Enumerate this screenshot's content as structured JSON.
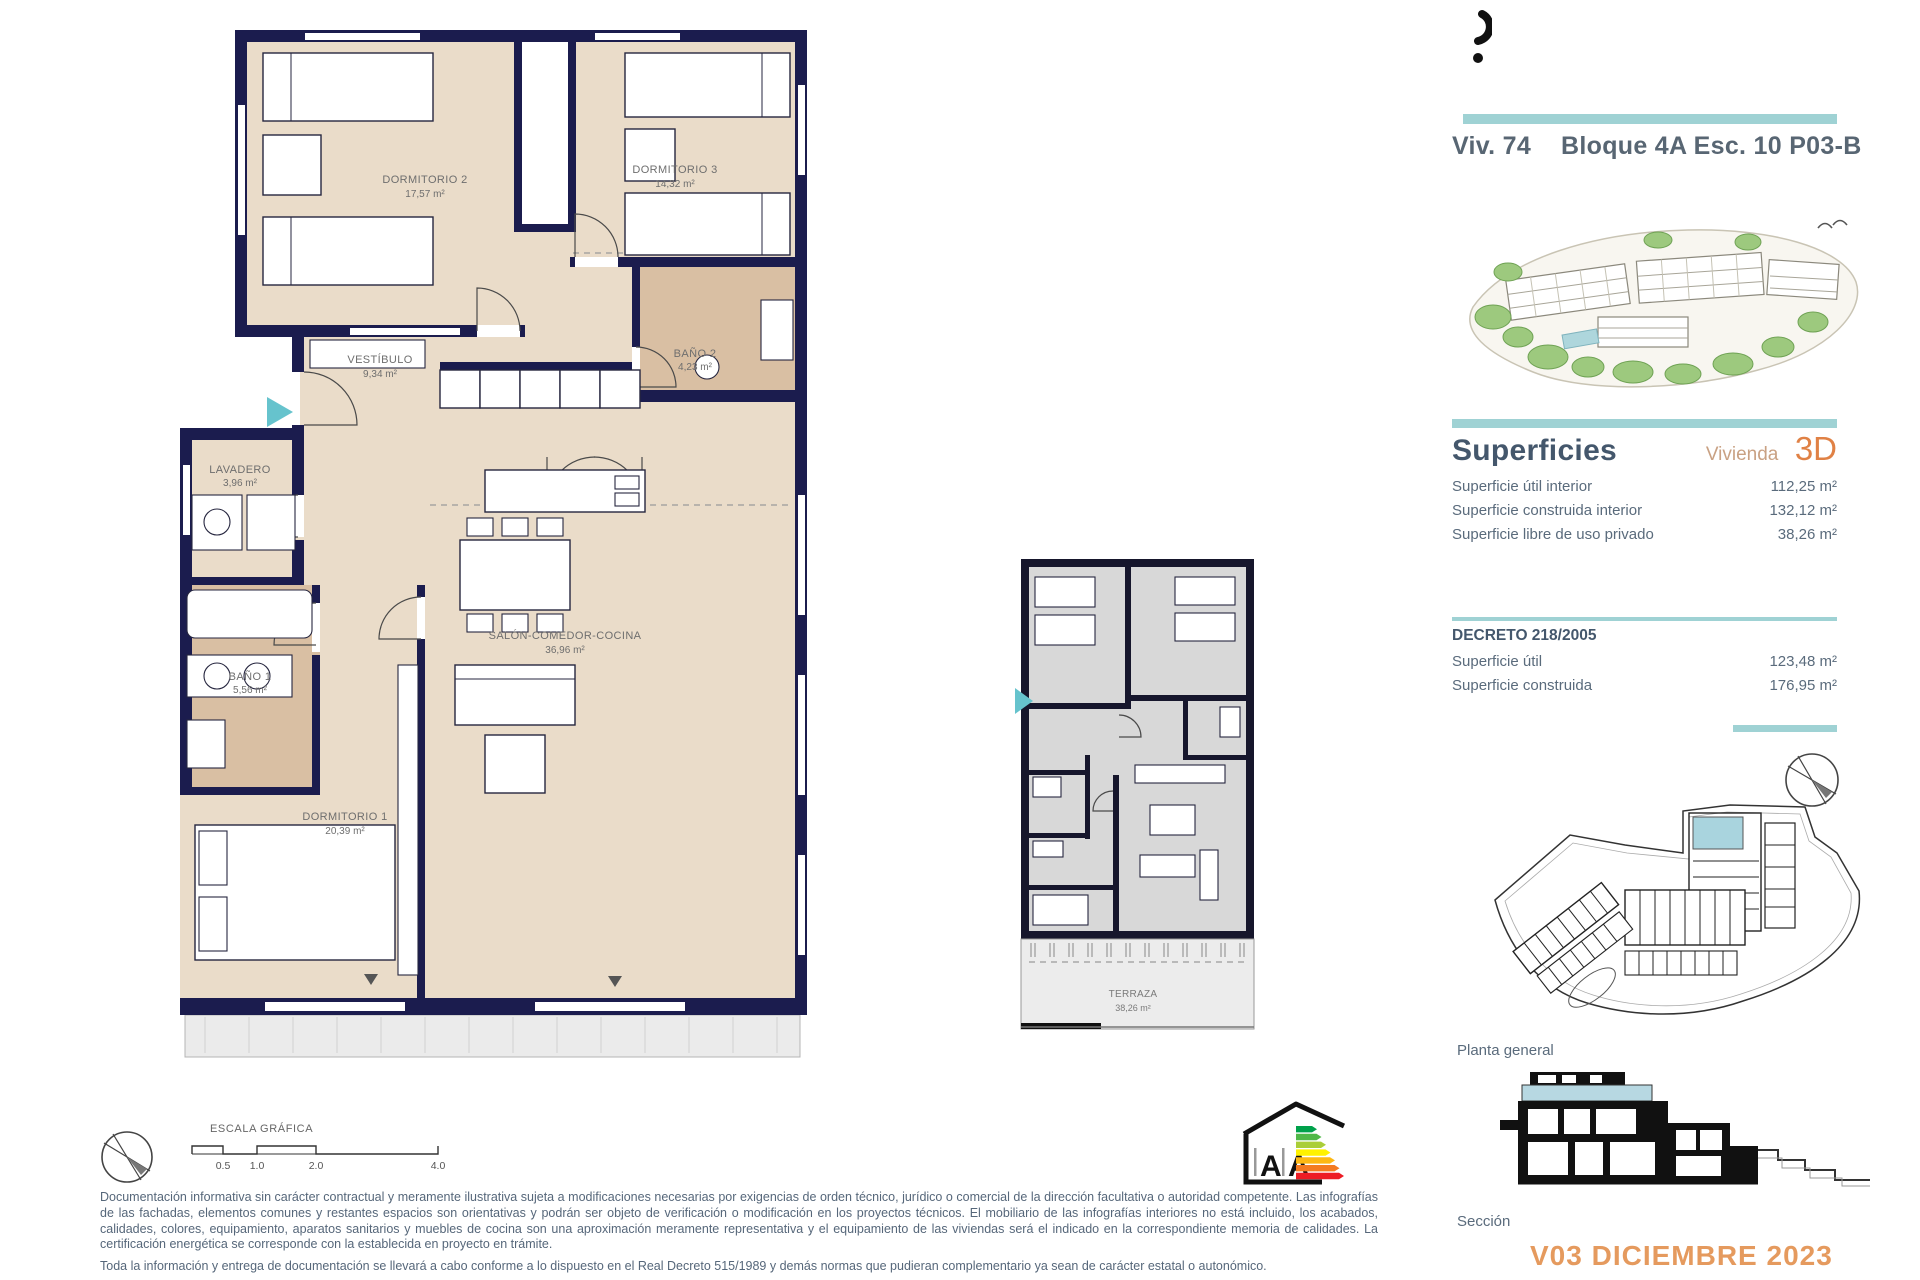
{
  "header": {
    "unit": "Viv. 74",
    "location": "Bloque 4A Esc. 10 P03-B"
  },
  "superficies": {
    "heading": "Superficies",
    "unit_label": "Vivienda",
    "unit_type": "3D",
    "rows": [
      {
        "label": "Superficie útil interior",
        "value": "112,25 m²"
      },
      {
        "label": "Superficie construida interior",
        "value": "132,12 m²"
      },
      {
        "label": "Superficie libre de uso privado",
        "value": "38,26 m²"
      }
    ]
  },
  "decreto": {
    "heading": "DECRETO 218/2005",
    "rows": [
      {
        "label": "Superficie útil",
        "value": "123,48 m²"
      },
      {
        "label": "Superficie construida",
        "value": "176,95 m²"
      }
    ]
  },
  "captions": {
    "site_plan": "Planta general",
    "section": "Sección",
    "version": "V03 DICIEMBRE 2023"
  },
  "floorplan": {
    "rooms": [
      {
        "name": "DORMITORIO 2",
        "area": "17,57 m²"
      },
      {
        "name": "DORMITORIO 3",
        "area": "14,32 m²"
      },
      {
        "name": "BAÑO 2",
        "area": "4,23 m²"
      },
      {
        "name": "VESTÍBULO",
        "area": "9,34 m²"
      },
      {
        "name": "LAVADERO",
        "area": "3,96 m²"
      },
      {
        "name": "BAÑO 1",
        "area": "5,56 m²"
      },
      {
        "name": "SALÓN-COMEDOR-COCINA",
        "area": "36,96 m²"
      },
      {
        "name": "DORMITORIO 1",
        "area": "20,39 m²"
      }
    ],
    "terrace": {
      "name": "TERRAZA",
      "area": "38,26 m²"
    }
  },
  "scale_bar": {
    "title": "ESCALA GRÁFICA",
    "ticks": [
      "0.5",
      "1.0",
      "2.0",
      "4.0"
    ]
  },
  "energy": {
    "left": "A",
    "right": "A"
  },
  "disclaimer": {
    "p1": "Documentación informativa sin carácter contractual y meramente ilustrativa sujeta a modificaciones necesarias por exigencias de orden técnico, jurídico o comercial de la dirección facultativa o autoridad competente. Las infografías de las fachadas, elementos comunes y restantes espacios son orientativas y podrán ser objeto de verificación o modificación en los proyectos técnicos. El mobiliario de las infografías interiores no está incluido, los acabados, calidades, colores, equipamiento, aparatos sanitarios y muebles de cocina son una aproximación meramente representativa y el equipamiento de las viviendas será el indicado en la correspondiente memoria de calidades. La certificación energética se corresponde con la establecida en proyecto en trámite.",
    "p2": "Toda la información y entrega de documentación se llevará a cabo conforme a lo dispuesto en el Real Decreto 515/1989 y demás normas que pudieran complementario ya sean de carácter estatal o autonómico."
  },
  "colors": {
    "accent_teal": "#9fd2d4",
    "wall_navy": "#1b1c4e",
    "floor_beige": "#eadcc9",
    "floor_tan": "#d9bfa3",
    "orange": "#e08145",
    "version_orange": "#e59a5e",
    "text_slate": "#5a6b7c"
  }
}
